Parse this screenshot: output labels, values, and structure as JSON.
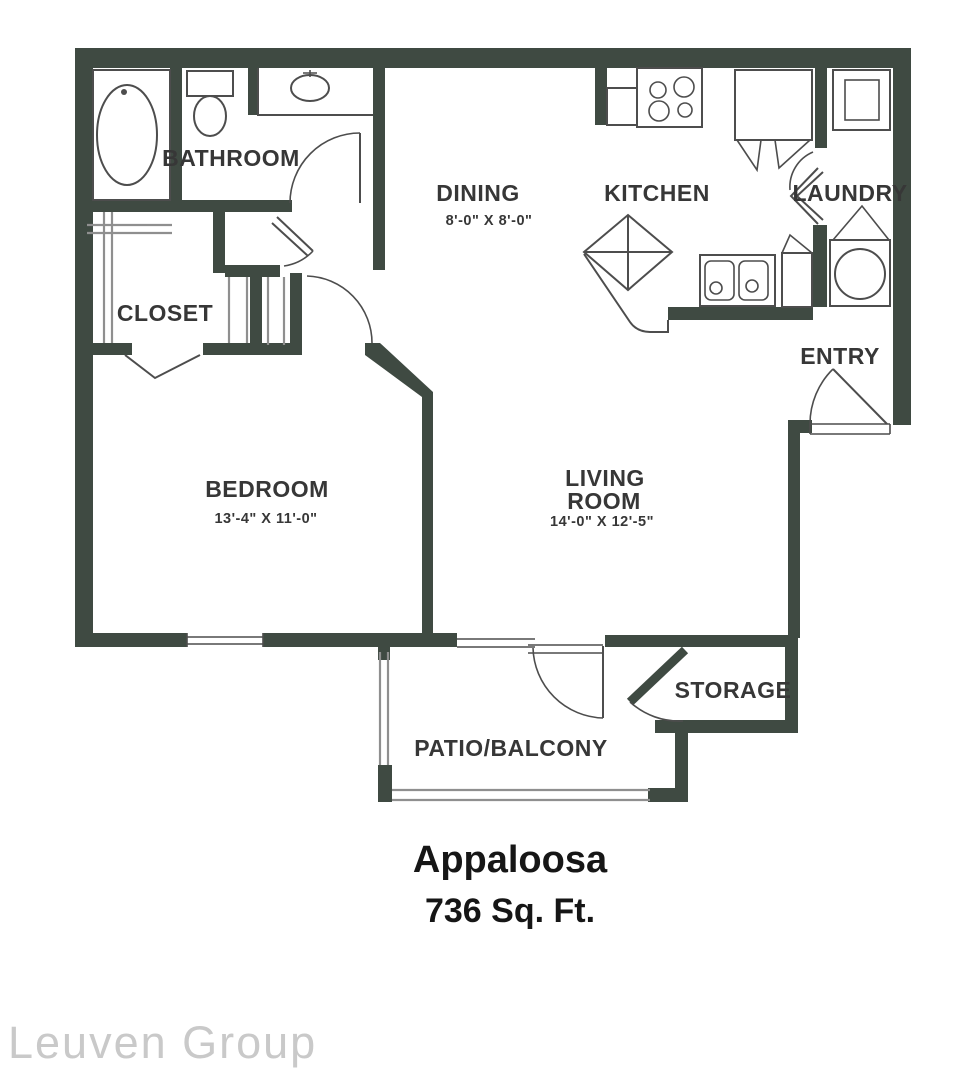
{
  "colors": {
    "wall": "#3f4a42",
    "line": "#4d4d4d",
    "rail": "#8f8f8f",
    "label": "#373737",
    "title": "#161616",
    "watermark": "#c9c9c9"
  },
  "rooms": {
    "bathroom": {
      "label": "BATHROOM"
    },
    "closet": {
      "label": "CLOSET"
    },
    "dining": {
      "label": "DINING",
      "dims": "8'-0\" X 8'-0\""
    },
    "kitchen": {
      "label": "KITCHEN"
    },
    "laundry": {
      "label": "LAUNDRY"
    },
    "entry": {
      "label": "ENTRY"
    },
    "bedroom": {
      "label": "BEDROOM",
      "dims": "13'-4\" X 11'-0\""
    },
    "living_room": {
      "line1": "LIVING",
      "line2": "ROOM",
      "dims": "14'-0\" X 12'-5\""
    },
    "storage": {
      "label": "STORAGE"
    },
    "patio": {
      "label": "PATIO/BALCONY"
    }
  },
  "plan_title": {
    "name": "Appaloosa",
    "area": "736 Sq. Ft."
  },
  "watermark": "Leuven Group"
}
